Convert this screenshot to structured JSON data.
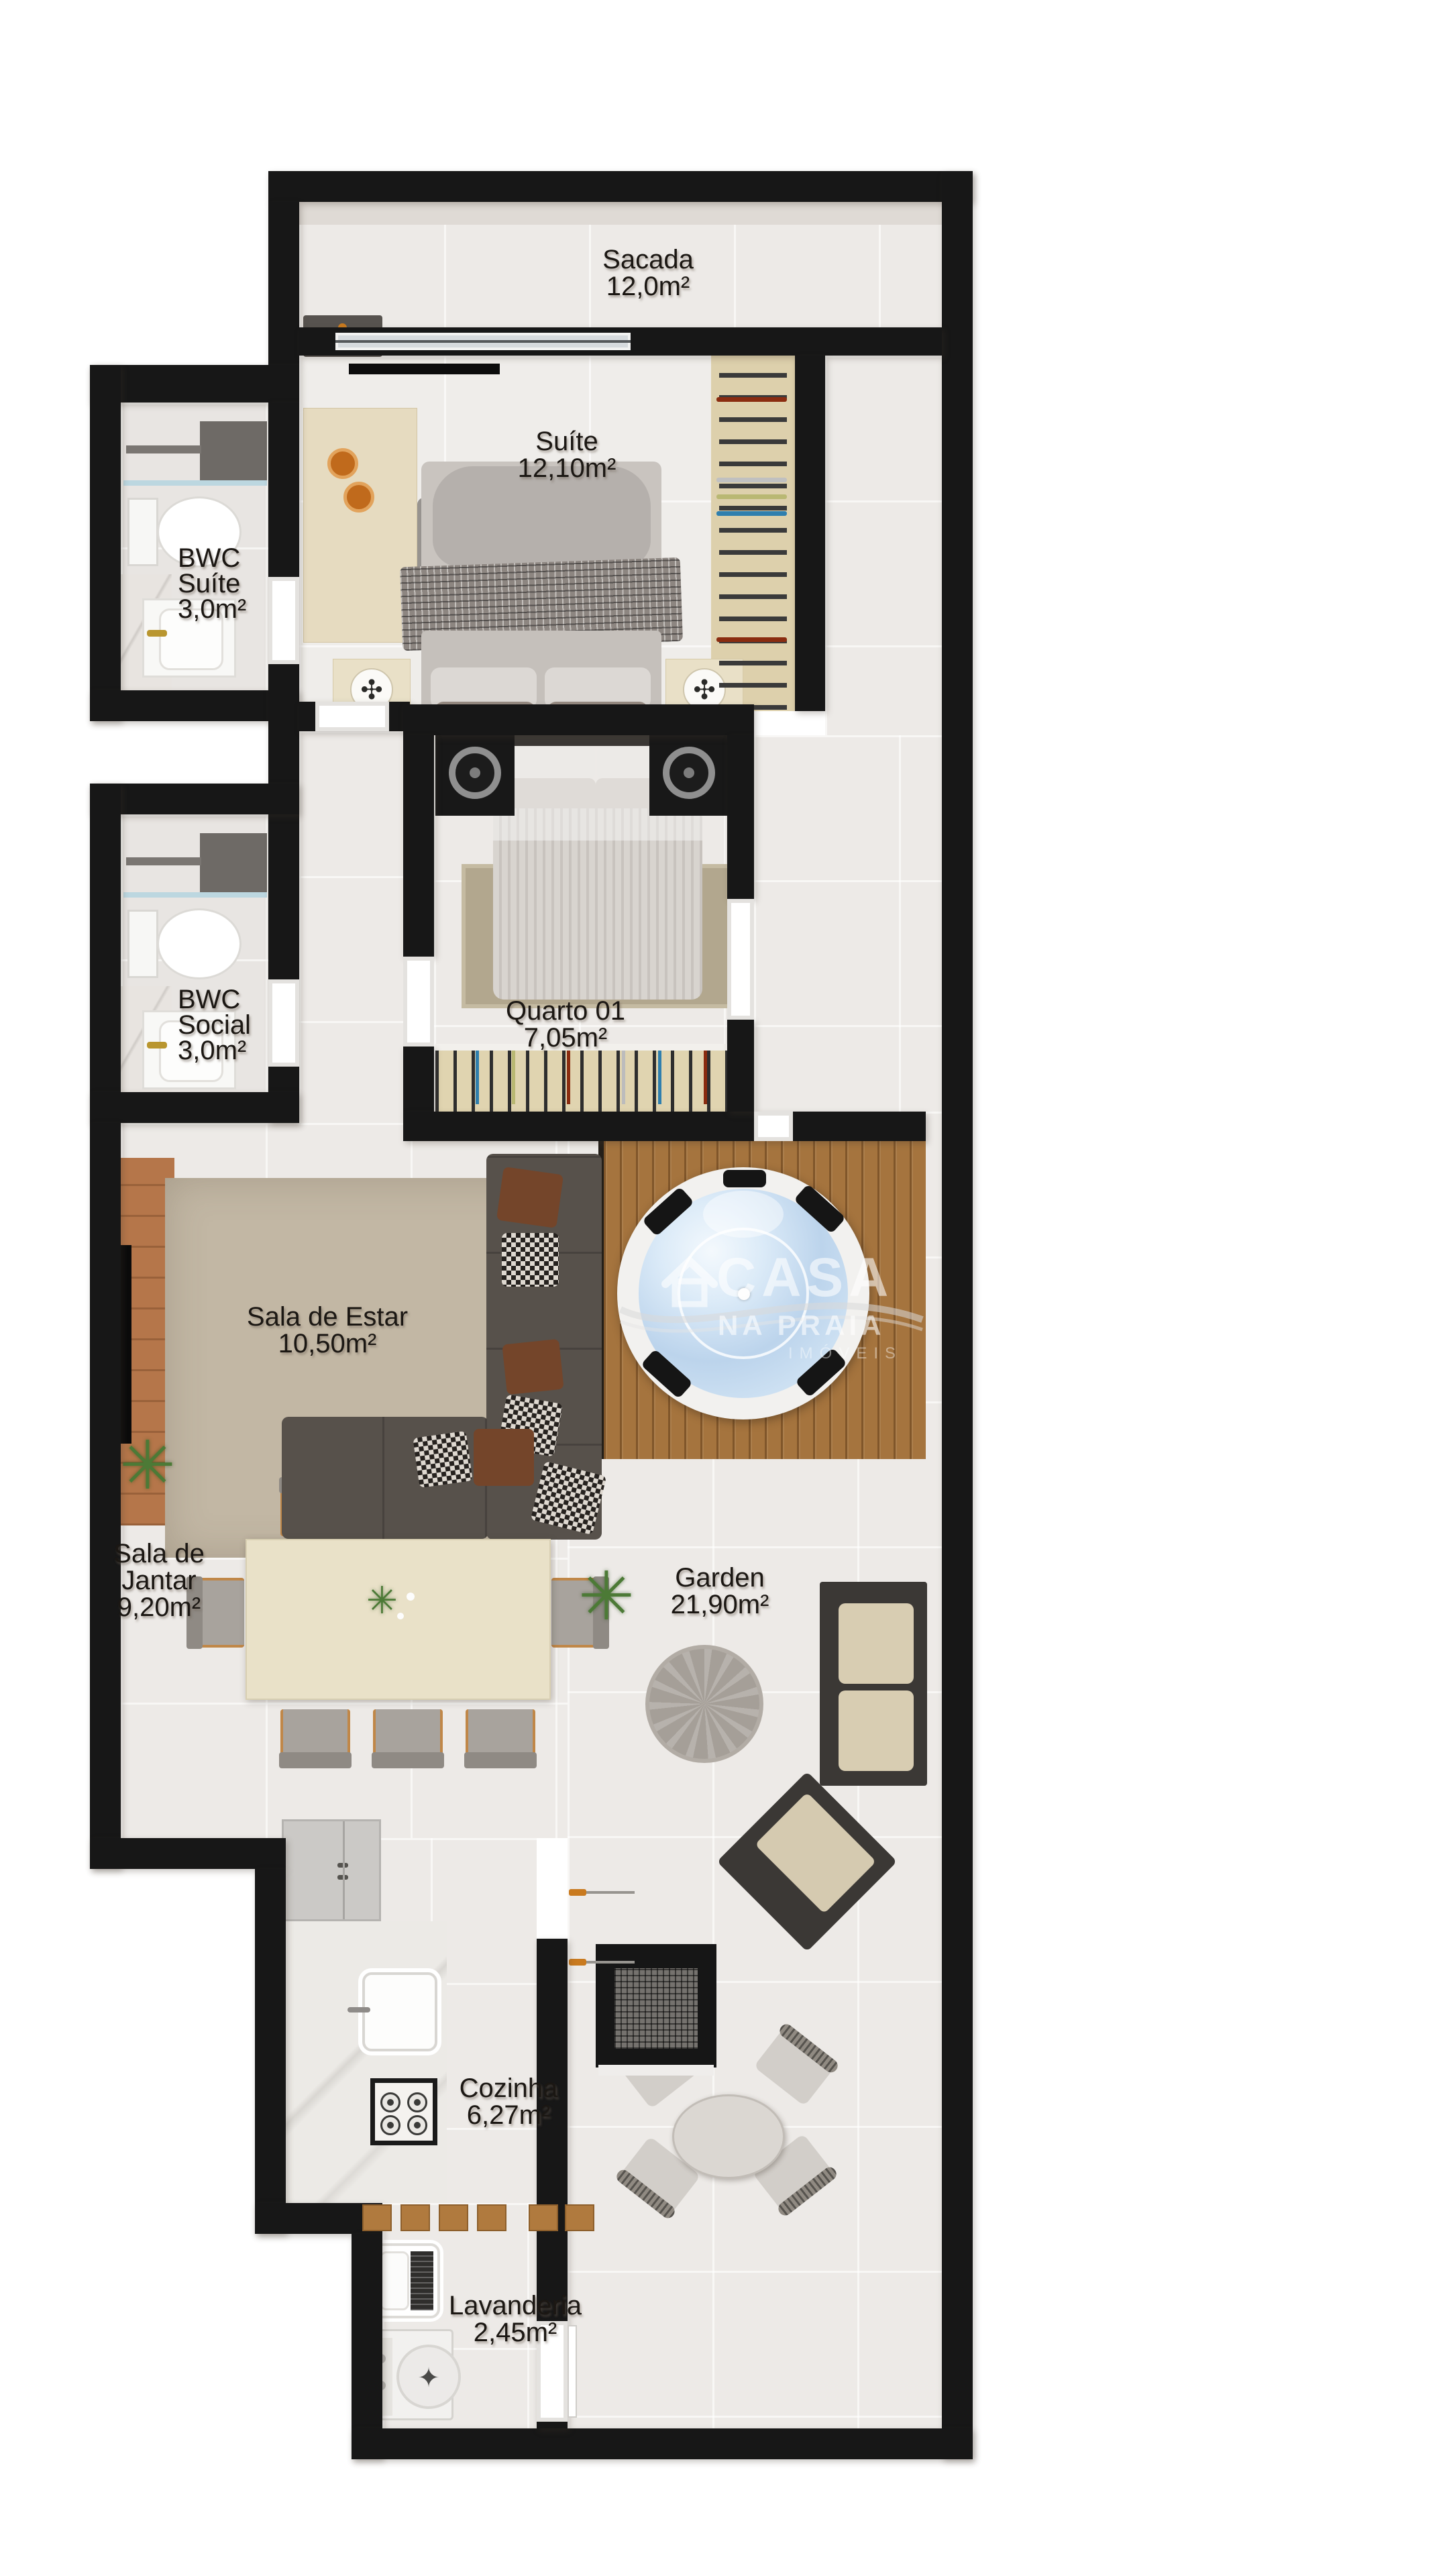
{
  "rooms": [
    {
      "id": "sacada",
      "lines": [
        "Sacada",
        "12,0m²"
      ]
    },
    {
      "id": "suite",
      "lines": [
        "Suíte",
        "12,10m²"
      ]
    },
    {
      "id": "bwc-suite",
      "lines": [
        "BWC",
        "Suíte",
        "3,0m²"
      ]
    },
    {
      "id": "quarto-01",
      "lines": [
        "Quarto 01",
        "7,05m²"
      ]
    },
    {
      "id": "bwc-social",
      "lines": [
        "BWC",
        "Social",
        "3,0m²"
      ]
    },
    {
      "id": "sala-de-estar",
      "lines": [
        "Sala de Estar",
        "10,50m²"
      ]
    },
    {
      "id": "sala-de-jantar",
      "lines": [
        "Sala de",
        "Jantar",
        "9,20m²"
      ]
    },
    {
      "id": "garden",
      "lines": [
        "Garden",
        "21,90m²"
      ]
    },
    {
      "id": "cozinha",
      "lines": [
        "Cozinha",
        "6,27m²"
      ]
    },
    {
      "id": "lavanderia",
      "lines": [
        "Lavanderia",
        "2,45m²"
      ]
    }
  ],
  "watermark": {
    "brand": "CASA",
    "tagline": "NA PRAIA",
    "subtitle": "IMÓVEIS",
    "icon": "house-logo-icon"
  },
  "glyphs": {
    "plant": "✳",
    "fan": "✣",
    "washer_star": "✦"
  },
  "colors": {
    "wall": "#171717",
    "floor_tile": "#edeae7",
    "wood_deck": "#a5743e",
    "closet_wood": "#ddd0ac",
    "living_rug": "#c2b7a4",
    "hot_tub_water": "#bcd4ec",
    "accent_orange": "#c97a1f"
  }
}
